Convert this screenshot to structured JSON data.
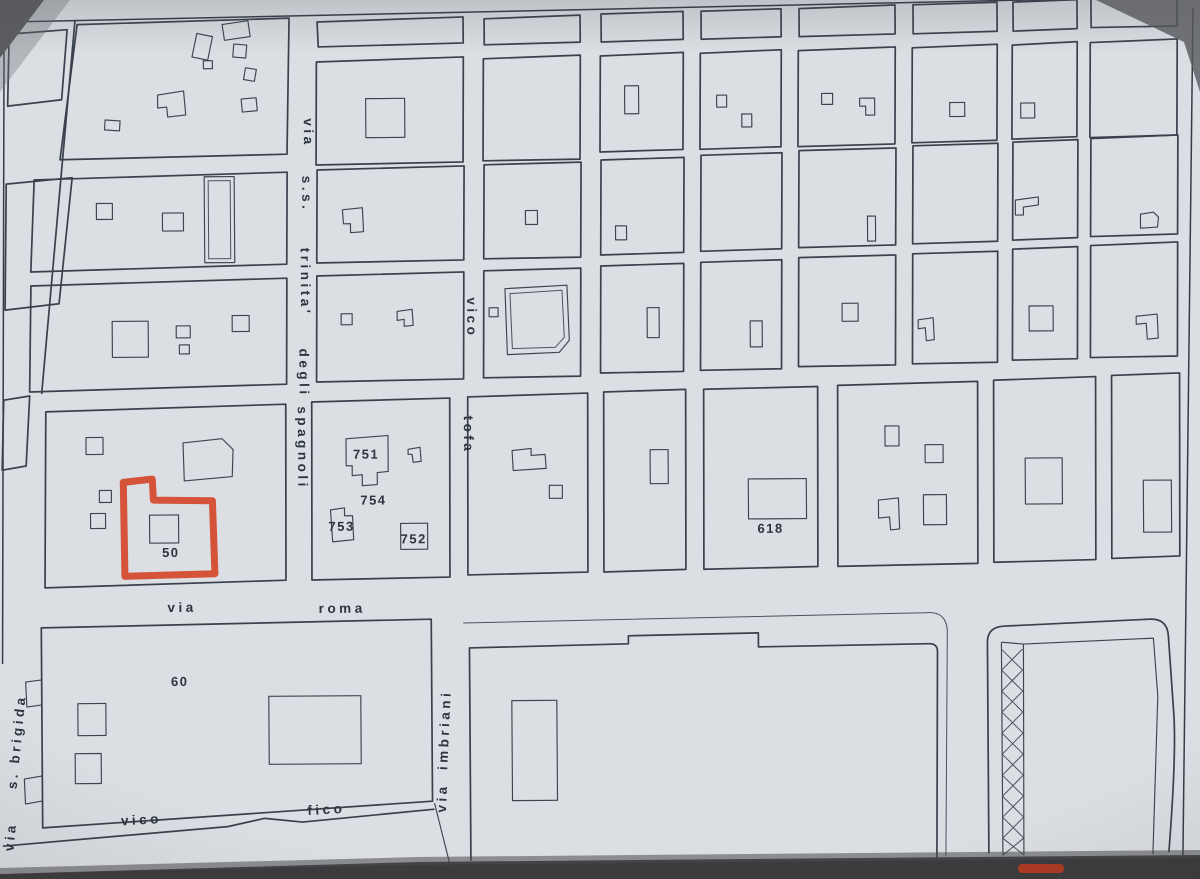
{
  "streets": {
    "spagnoli": {
      "words": [
        "via",
        "s.s.",
        "trinita'",
        "degli",
        "spagnoli"
      ]
    },
    "tofa": {
      "words": [
        "vico",
        "tofa"
      ]
    },
    "roma": {
      "words": [
        "via",
        "roma"
      ]
    },
    "imbriani": {
      "words": [
        "via",
        "imbriani"
      ]
    },
    "brigida": {
      "words": [
        "via",
        "s. brigida"
      ]
    },
    "fico": {
      "words": [
        "vico",
        "fico"
      ]
    }
  },
  "parcels": {
    "highlighted": {
      "number": "50"
    },
    "numbers": {
      "n751": "751",
      "n754": "754",
      "n753": "753",
      "n752": "752",
      "n618": "618",
      "n60": "60"
    }
  },
  "colors": {
    "highlight": "#d4492c",
    "ink": "#323a46",
    "paper": "#dde0e5"
  }
}
